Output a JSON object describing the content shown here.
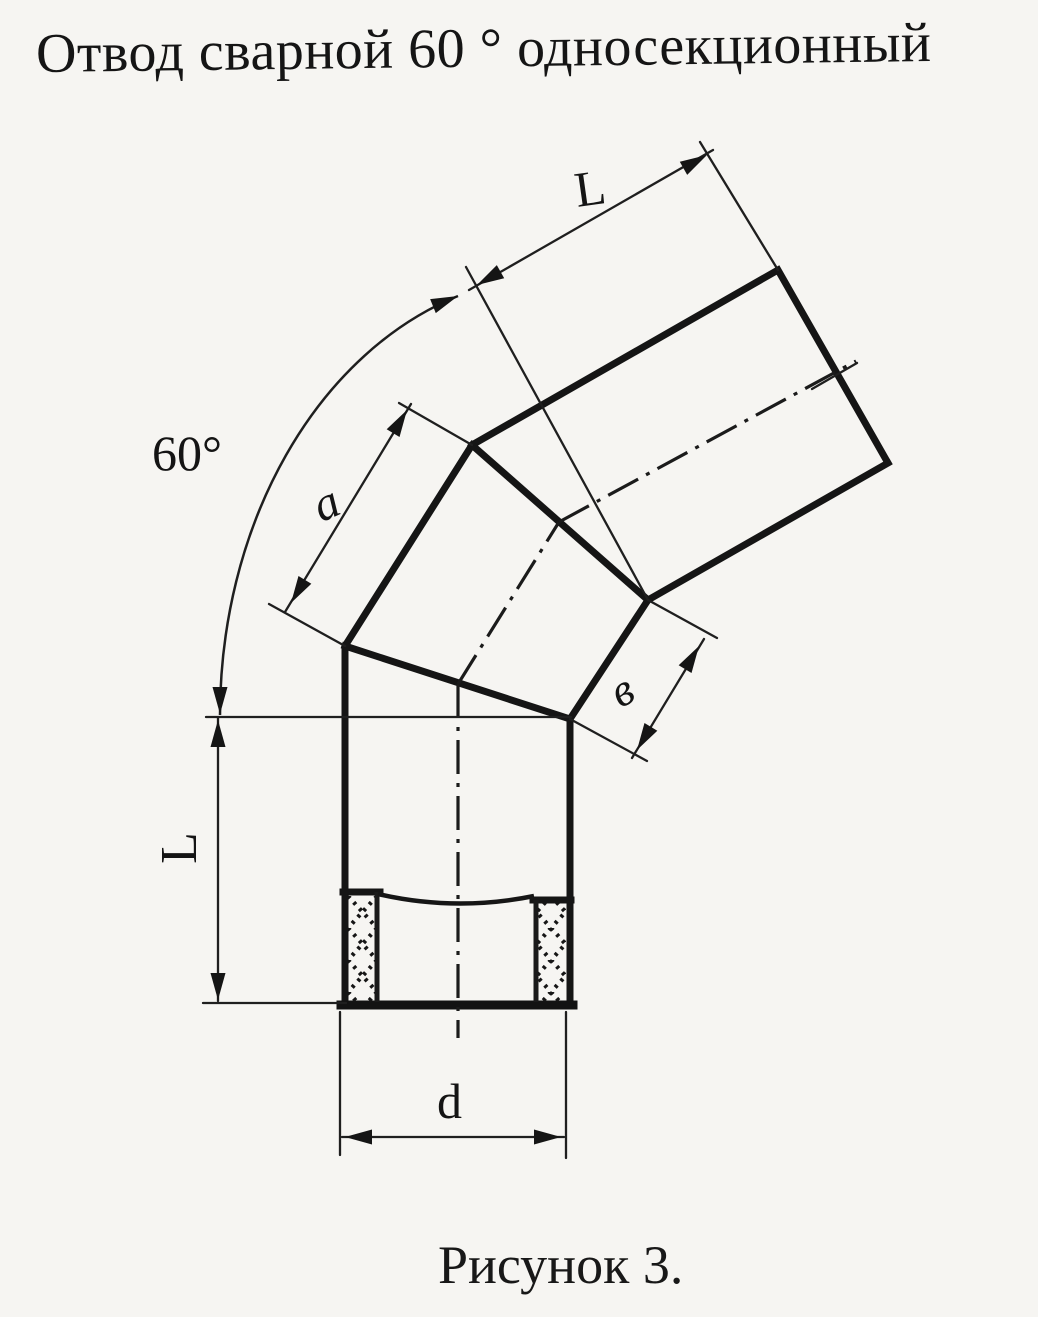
{
  "title": "Отвод сварной 60 ° односекционный",
  "caption": "Рисунок 3.",
  "colors": {
    "paper": "#f6f5f2",
    "ink": "#151515"
  },
  "drawing": {
    "labels": {
      "angle": "60°",
      "length_top": "L",
      "outer_side": "a",
      "inner_side": "в",
      "length_left": "L",
      "diameter": "d"
    }
  }
}
